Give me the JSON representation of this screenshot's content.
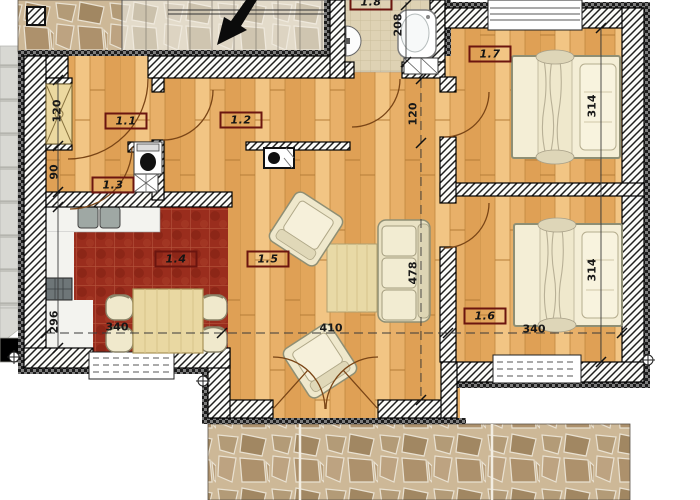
{
  "floorplan": {
    "room_labels": {
      "r11": "1.1",
      "r12": "1.2",
      "r13": "1.3",
      "r14": "1.4",
      "r15": "1.5",
      "r16": "1.6",
      "r17": "1.7",
      "r18": "1.8"
    },
    "dimensions": {
      "wardrobe_niche": "120",
      "wc_width": "90",
      "kitchen_depth": "296",
      "kitchen_width": "340",
      "living_width": "410",
      "bedroom2_width": "340",
      "bathroom_width": "208",
      "hallway_depth": "120",
      "living_depth": "478",
      "bedroom1_depth": "314",
      "bedroom2_depth": "314"
    },
    "furniture": [
      "bed",
      "bed",
      "sofa",
      "coffee-table",
      "armchair",
      "armchair",
      "dining-table",
      "chair",
      "wardrobe",
      "kitchen-sink",
      "stove",
      "toilet",
      "washbasin",
      "bathtub",
      "bathroom-sink",
      "washing-machine",
      "chimney"
    ],
    "colors": {
      "wood_floor": "#ecb873",
      "kitchen_tile": "#9a2d1d",
      "bath_tile": "#ded2b4",
      "wall": "#1c1c1c",
      "label_border": "#6b150f",
      "stone_paving": "#cdb897",
      "furniture_cream": "#f2ecd2"
    }
  }
}
